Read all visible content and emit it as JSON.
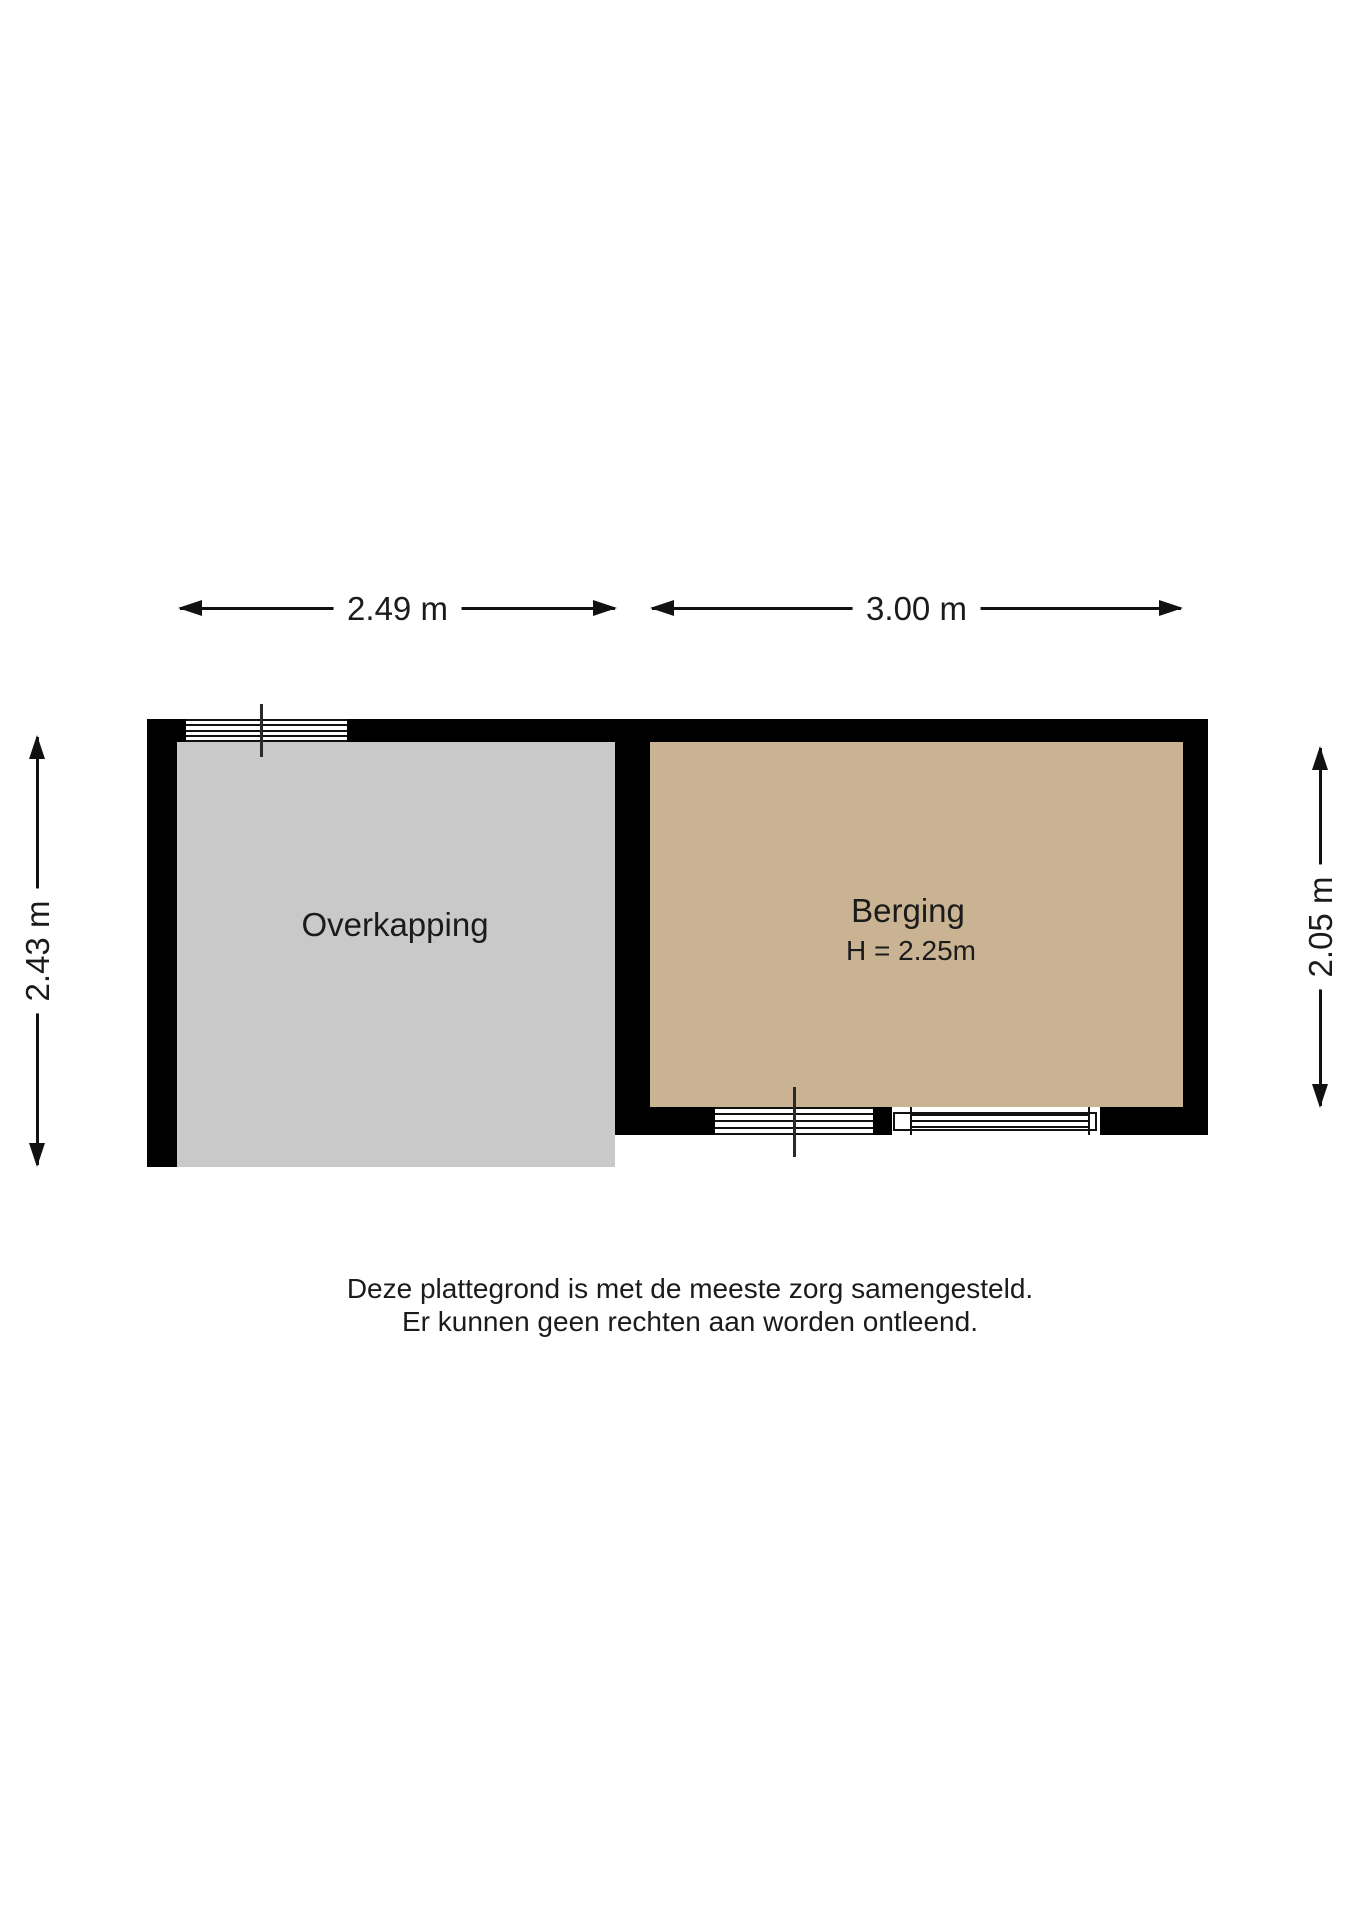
{
  "floorplan": {
    "dimensions": {
      "overkapping_width": "2.49 m",
      "berging_width": "3.00 m",
      "overkapping_depth": "2.43 m",
      "berging_depth": "2.05 m"
    },
    "rooms": {
      "overkapping": {
        "name": "Overkapping",
        "fill": "#c9c9c9"
      },
      "berging": {
        "name": "Berging",
        "ceiling_height": "H = 2.25m",
        "fill": "#c9b392"
      }
    },
    "colors": {
      "wall": "#000000",
      "dimension_line": "#111111",
      "text": "#1b1b1b"
    },
    "disclaimer": {
      "line1": "Deze plattegrond is met de meeste zorg samengesteld.",
      "line2": "Er kunnen geen rechten aan worden ontleend."
    }
  }
}
